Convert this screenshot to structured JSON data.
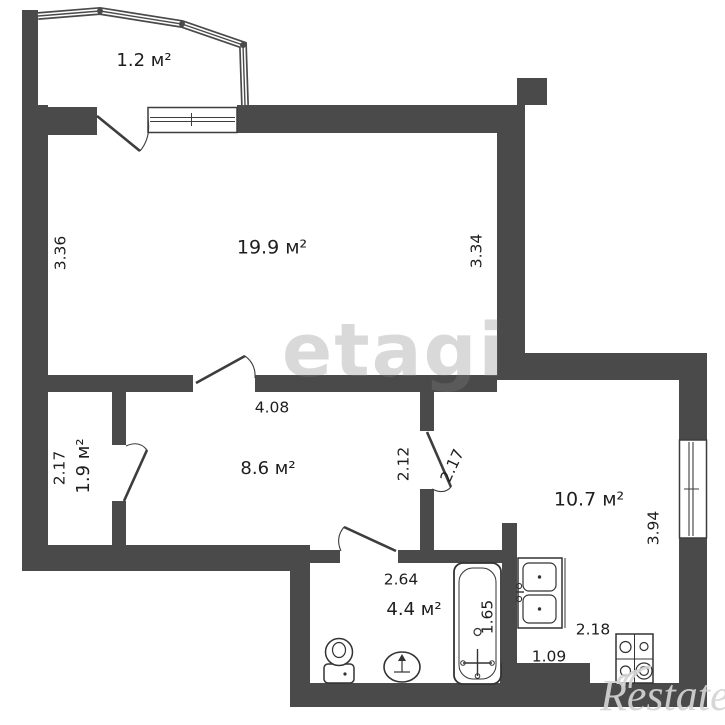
{
  "watermarks": {
    "center": "etagi",
    "brand": "Restate"
  },
  "rooms": {
    "balcony": {
      "area": "1.2 м²"
    },
    "living": {
      "area": "19.9 м²",
      "dim_left": "3.36",
      "dim_right": "3.34"
    },
    "closet": {
      "area": "1.9 м²",
      "dim_left": "2.17"
    },
    "hallway": {
      "area": "8.6 м²",
      "dim_top": "4.08",
      "dim_right": "2.12"
    },
    "kitchen": {
      "area": "10.7 м²",
      "dim_door": "2.17",
      "dim_right": "3.94",
      "dim_bottom": "2.18",
      "dim_step": "1.09"
    },
    "bathroom": {
      "area": "4.4 м²",
      "dim_top": "2.64",
      "dim_tub": "1.65"
    }
  },
  "colors": {
    "wall": "#4a4a4a",
    "line": "#3d3d3d",
    "background": "#ffffff",
    "text": "#1e1e1e",
    "watermark": "#bdbdbd"
  },
  "fixtures": {
    "bathtub": "bathtub",
    "toilet": "toilet",
    "sink": "pedestal-sink",
    "kitchen_sink": "double-kitchen-sink",
    "stove": "stove-4-burners"
  }
}
